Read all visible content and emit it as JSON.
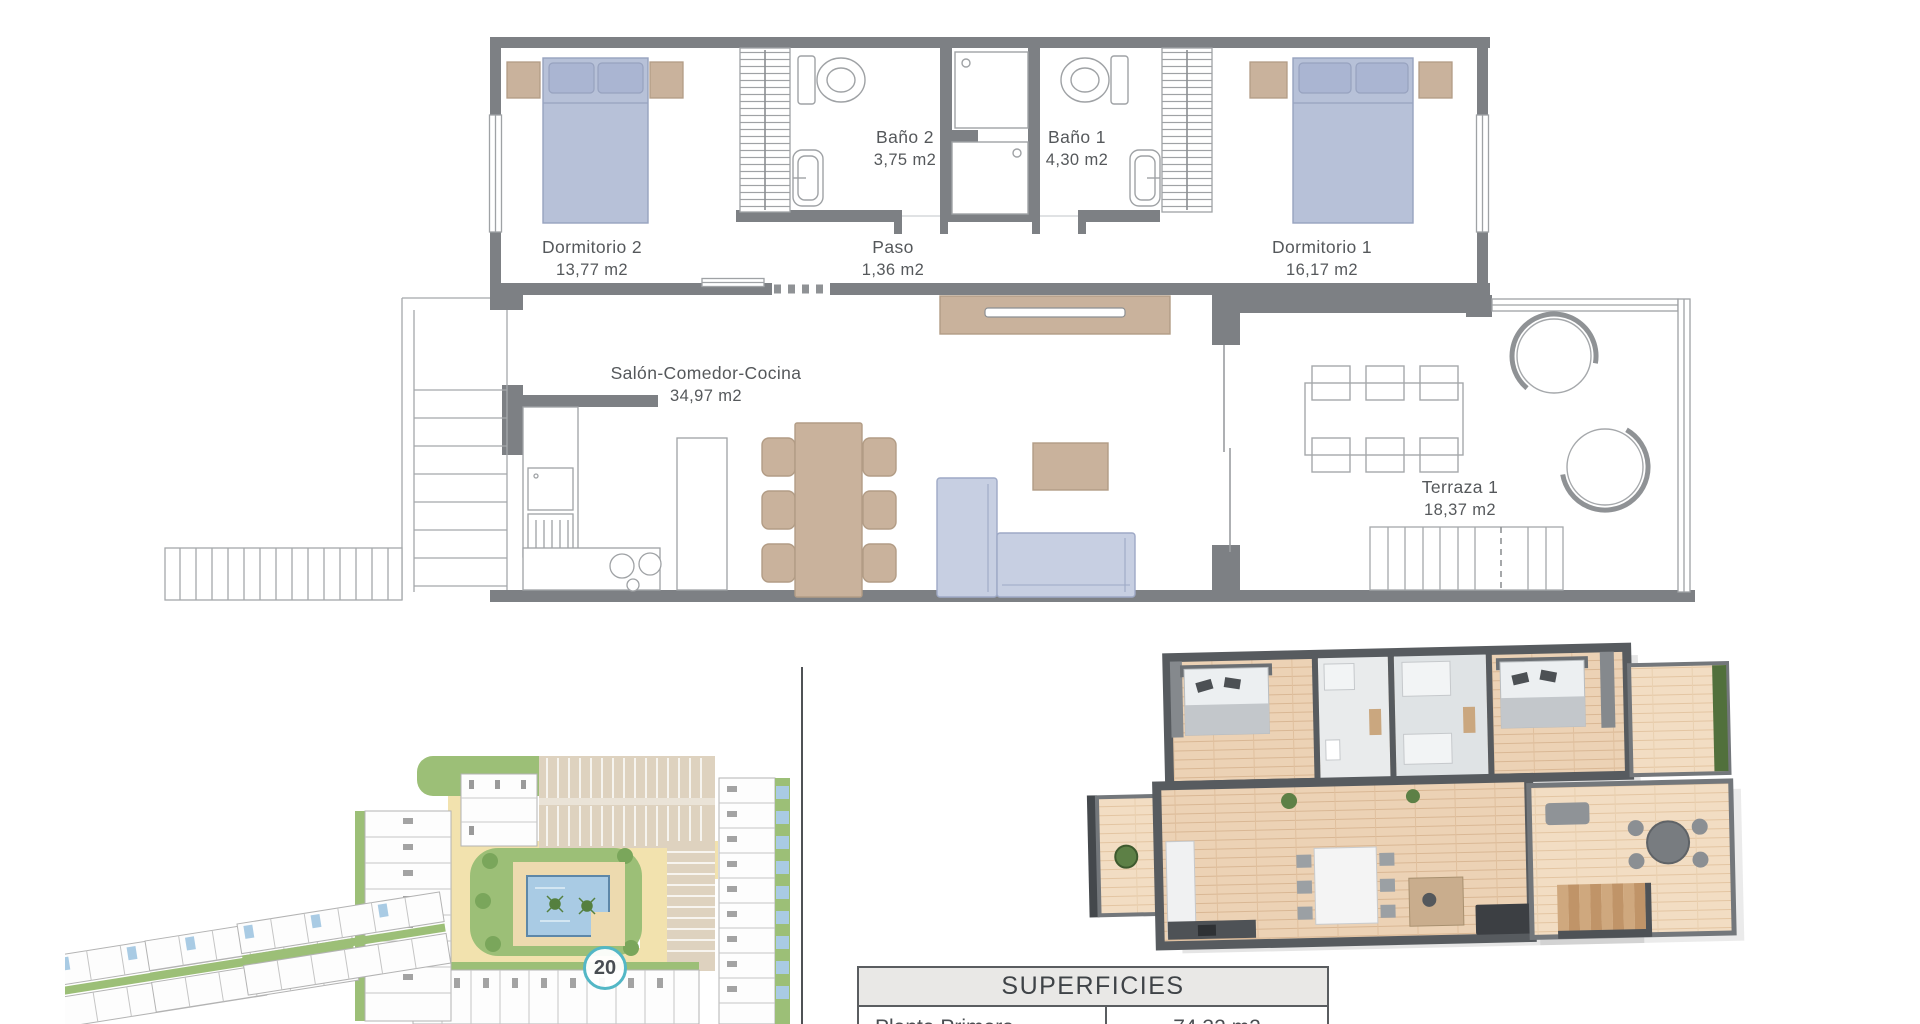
{
  "floor_plan": {
    "rooms": [
      {
        "id": "dormitorio2",
        "name": "Dormitorio 2",
        "area": "13,77 m2"
      },
      {
        "id": "bano2",
        "name": "Baño 2",
        "area": "3,75 m2"
      },
      {
        "id": "bano1",
        "name": "Baño 1",
        "area": "4,30 m2"
      },
      {
        "id": "paso",
        "name": "Paso",
        "area": "1,36 m2"
      },
      {
        "id": "dormitorio1",
        "name": "Dormitorio 1",
        "area": "16,17 m2"
      },
      {
        "id": "salon",
        "name": "Salón-Comedor-Cocina",
        "area": "34,97 m2"
      },
      {
        "id": "terraza1",
        "name": "Terraza 1",
        "area": "18,37 m2"
      }
    ]
  },
  "site_plan": {
    "unit_badge": "20"
  },
  "superficies_table": {
    "title": "SUPERFICIES",
    "rows": [
      {
        "label": "Planta Primera",
        "value": "74,32 m2"
      }
    ]
  },
  "colors": {
    "wall_gray": "#7d8084",
    "thin_line": "#a5a8ab",
    "furniture_blue": "#b7c1d8",
    "furniture_tan": "#c9b29c",
    "label_text": "#55585b",
    "badge_ring": "#53b7c6",
    "site_green": "#9cbf77",
    "site_yellow": "#f2e2ae",
    "site_parking_beige": "#ded2bf",
    "pool_blue": "#a9cbe4",
    "render_wall": "#575b5f",
    "render_floor": "#ecd2b5"
  }
}
